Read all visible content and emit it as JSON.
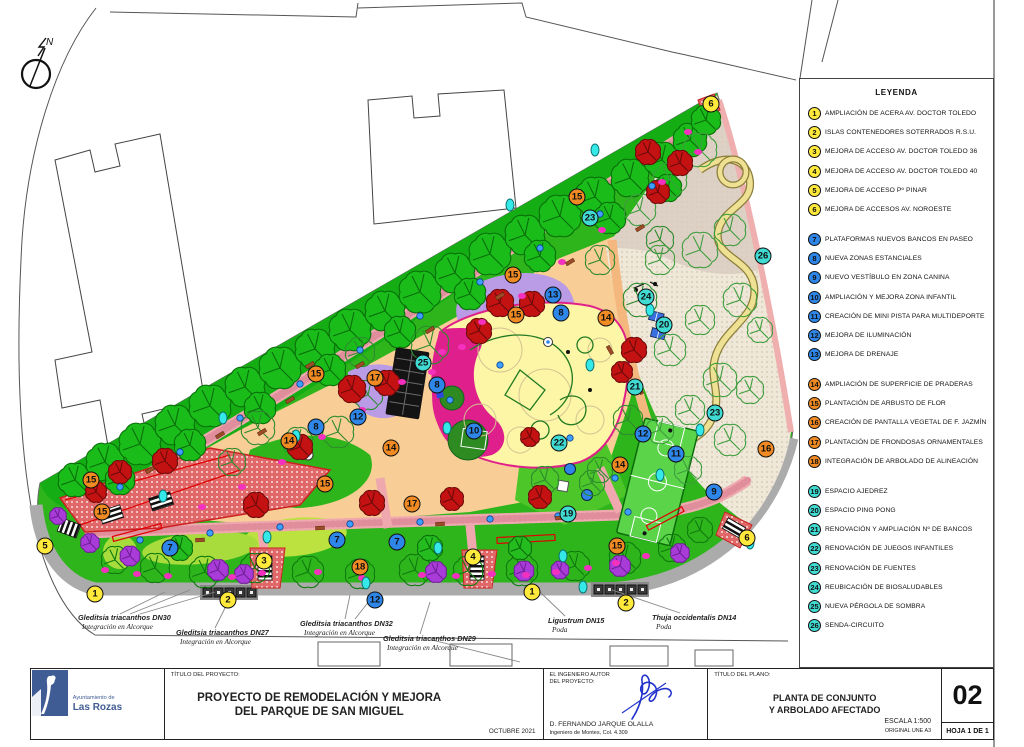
{
  "legend": {
    "title": "LEYENDA",
    "groups": [
      {
        "kind": "access",
        "color": "#FFE93B",
        "items": [
          {
            "num": "1",
            "label": "AMPLIACIÓN DE ACERA AV. DOCTOR TOLEDO"
          },
          {
            "num": "2",
            "label": "ISLAS CONTENEDORES SOTERRADOS R.S.U."
          },
          {
            "num": "3",
            "label": "MEJORA DE ACCESO AV. DOCTOR TOLEDO 36"
          },
          {
            "num": "4",
            "label": "MEJORA DE ACCESO AV. DOCTOR TOLEDO 40"
          },
          {
            "num": "5",
            "label": "MEJORA DE ACCESO Pº PINAR"
          },
          {
            "num": "6",
            "label": "MEJORA DE ACCESOS AV. NOROESTE"
          }
        ]
      },
      {
        "kind": "mejora",
        "color": "#2E86E8",
        "items": [
          {
            "num": "7",
            "label": "PLATAFORMAS NUEVOS BANCOS EN PASEO"
          },
          {
            "num": "8",
            "label": "NUEVA ZONAS ESTANCIALES"
          },
          {
            "num": "9",
            "label": "NUEVO VESTÍBULO EN ZONA CANINA"
          },
          {
            "num": "10",
            "label": "AMPLIACIÓN Y MEJORA ZONA INFANTIL"
          },
          {
            "num": "11",
            "label": "CREACIÓN DE MINI PISTA PARA MULTIDEPORTE"
          },
          {
            "num": "12",
            "label": "MEJORA DE ILUMINACIÓN"
          },
          {
            "num": "13",
            "label": "MEJORA DE DRENAJE"
          }
        ]
      },
      {
        "kind": "plantacion",
        "color": "#F08A22",
        "items": [
          {
            "num": "14",
            "label": "AMPLIACIÓN DE SUPERFICIE DE PRADERAS"
          },
          {
            "num": "15",
            "label": "PLANTACIÓN DE ARBUSTO DE FLOR"
          },
          {
            "num": "16",
            "label": "CREACIÓN DE PANTALLA VEGETAL DE F. JAZMÍN"
          },
          {
            "num": "17",
            "label": "PLANTACIÓN DE FRONDOSAS ORNAMENTALES"
          },
          {
            "num": "18",
            "label": "INTEGRACIÓN DE ARBOLADO DE ALINEACIÓN"
          }
        ]
      },
      {
        "kind": "renovacion",
        "color": "#40DBD3",
        "items": [
          {
            "num": "19",
            "label": "ESPACIO AJEDREZ"
          },
          {
            "num": "20",
            "label": "ESPACIO PING PONG"
          },
          {
            "num": "21",
            "label": "RENOVACIÓN Y AMPLIACIÓN Nº DE BANCOS"
          },
          {
            "num": "22",
            "label": "RENOVACIÓN DE JUEGOS INFANTILES"
          },
          {
            "num": "23",
            "label": "RENOVACIÓN DE FUENTES"
          },
          {
            "num": "24",
            "label": "REUBICACIÓN DE BIOSALUDABLES"
          },
          {
            "num": "25",
            "label": "NUEVA PÉRGOLA DE SOMBRA"
          },
          {
            "num": "26",
            "label": "SENDA-CIRCUITO"
          }
        ]
      }
    ]
  },
  "plan": {
    "marker_colors": {
      "access": "#FFE93B",
      "mejora": "#2E86E8",
      "plantacion": "#F08A22",
      "renovacion": "#40DBD3"
    },
    "markers": [
      {
        "kind": "access",
        "num": "6",
        "x": 711,
        "y": 104
      },
      {
        "kind": "access",
        "num": "5",
        "x": 45,
        "y": 546
      },
      {
        "kind": "access",
        "num": "1",
        "x": 95,
        "y": 594
      },
      {
        "kind": "access",
        "num": "2",
        "x": 228,
        "y": 600
      },
      {
        "kind": "access",
        "num": "3",
        "x": 264,
        "y": 561
      },
      {
        "kind": "access",
        "num": "4",
        "x": 473,
        "y": 557
      },
      {
        "kind": "access",
        "num": "1",
        "x": 532,
        "y": 592
      },
      {
        "kind": "access",
        "num": "2",
        "x": 626,
        "y": 603
      },
      {
        "kind": "access",
        "num": "6",
        "x": 747,
        "y": 538
      },
      {
        "kind": "mejora",
        "num": "13",
        "x": 553,
        "y": 295
      },
      {
        "kind": "mejora",
        "num": "8",
        "x": 561,
        "y": 313
      },
      {
        "kind": "mejora",
        "num": "8",
        "x": 437,
        "y": 385
      },
      {
        "kind": "mejora",
        "num": "12",
        "x": 358,
        "y": 417
      },
      {
        "kind": "mejora",
        "num": "8",
        "x": 316,
        "y": 427
      },
      {
        "kind": "mejora",
        "num": "10",
        "x": 474,
        "y": 431
      },
      {
        "kind": "mejora",
        "num": "7",
        "x": 170,
        "y": 548
      },
      {
        "kind": "mejora",
        "num": "7",
        "x": 337,
        "y": 540
      },
      {
        "kind": "mejora",
        "num": "7",
        "x": 397,
        "y": 542
      },
      {
        "kind": "mejora",
        "num": "12",
        "x": 375,
        "y": 600
      },
      {
        "kind": "mejora",
        "num": "12",
        "x": 643,
        "y": 434
      },
      {
        "kind": "mejora",
        "num": "11",
        "x": 676,
        "y": 454
      },
      {
        "kind": "mejora",
        "num": "9",
        "x": 714,
        "y": 492
      },
      {
        "kind": "plantacion",
        "num": "15",
        "x": 577,
        "y": 197
      },
      {
        "kind": "plantacion",
        "num": "15",
        "x": 513,
        "y": 275
      },
      {
        "kind": "plantacion",
        "num": "15",
        "x": 516,
        "y": 315
      },
      {
        "kind": "plantacion",
        "num": "14",
        "x": 606,
        "y": 318
      },
      {
        "kind": "plantacion",
        "num": "15",
        "x": 316,
        "y": 374
      },
      {
        "kind": "plantacion",
        "num": "17",
        "x": 375,
        "y": 378
      },
      {
        "kind": "plantacion",
        "num": "14",
        "x": 391,
        "y": 448
      },
      {
        "kind": "plantacion",
        "num": "14",
        "x": 289,
        "y": 441
      },
      {
        "kind": "plantacion",
        "num": "15",
        "x": 325,
        "y": 484
      },
      {
        "kind": "plantacion",
        "num": "17",
        "x": 412,
        "y": 504
      },
      {
        "kind": "plantacion",
        "num": "18",
        "x": 360,
        "y": 567
      },
      {
        "kind": "plantacion",
        "num": "15",
        "x": 91,
        "y": 480
      },
      {
        "kind": "plantacion",
        "num": "15",
        "x": 102,
        "y": 512
      },
      {
        "kind": "plantacion",
        "num": "16",
        "x": 766,
        "y": 449
      },
      {
        "kind": "plantacion",
        "num": "14",
        "x": 620,
        "y": 465
      },
      {
        "kind": "plantacion",
        "num": "15",
        "x": 617,
        "y": 546
      },
      {
        "kind": "renovacion",
        "num": "23",
        "x": 590,
        "y": 218
      },
      {
        "kind": "renovacion",
        "num": "26",
        "x": 763,
        "y": 256
      },
      {
        "kind": "renovacion",
        "num": "24",
        "x": 646,
        "y": 297
      },
      {
        "kind": "renovacion",
        "num": "20",
        "x": 664,
        "y": 325
      },
      {
        "kind": "renovacion",
        "num": "25",
        "x": 423,
        "y": 363
      },
      {
        "kind": "renovacion",
        "num": "21",
        "x": 635,
        "y": 387
      },
      {
        "kind": "renovacion",
        "num": "23",
        "x": 715,
        "y": 413
      },
      {
        "kind": "renovacion",
        "num": "22",
        "x": 559,
        "y": 443
      },
      {
        "kind": "renovacion",
        "num": "19",
        "x": 568,
        "y": 514
      }
    ]
  },
  "annotations": [
    {
      "name": "Gleditsia triacanthos DN30",
      "action": "Integración en Alcorque",
      "x": 78,
      "y": 613
    },
    {
      "name": "Gleditsia triacanthos DN27",
      "action": "Integración en Alcorque",
      "x": 176,
      "y": 628
    },
    {
      "name": "Gleditsia triacanthos DN32",
      "action": "Integración en Alcorque",
      "x": 300,
      "y": 619
    },
    {
      "name": "Gleditsia triacanthos DN29",
      "action": "Integración en Alcorque",
      "x": 383,
      "y": 634
    },
    {
      "name": "Ligustrum DN15",
      "action": "Poda",
      "x": 548,
      "y": 616
    },
    {
      "name": "Thuja occidentalis DN14",
      "action": "Poda",
      "x": 652,
      "y": 613
    }
  ],
  "compass": {
    "label": "N"
  },
  "title_block": {
    "org_small": "Ayuntamiento de",
    "org_large": "Las Rozas",
    "project_label": "TÍTULO DEL PROYECTO:",
    "project_title_line1": "PROYECTO DE REMODELACIÓN Y MEJORA",
    "project_title_line2": "DEL PARQUE DE SAN MIGUEL",
    "date": "OCTUBRE 2021",
    "engineer_label_line1": "EL INGENIERO AUTOR",
    "engineer_label_line2": "DEL PROYECTO:",
    "engineer_name": "D. FERNANDO JARQUE OLALLA",
    "engineer_title": "Ingeniero de Montes, Col. 4.309",
    "plan_label": "TÍTULO DEL PLANO:",
    "plan_title_line1": "PLANTA DE CONJUNTO",
    "plan_title_line2": "Y ARBOLADO AFECTADO",
    "scale": "ESCALA 1:500",
    "original": "ORIGINAL UNE A3",
    "sheet_number": "02",
    "sheet_info": "HOJA 1 DE 1"
  }
}
